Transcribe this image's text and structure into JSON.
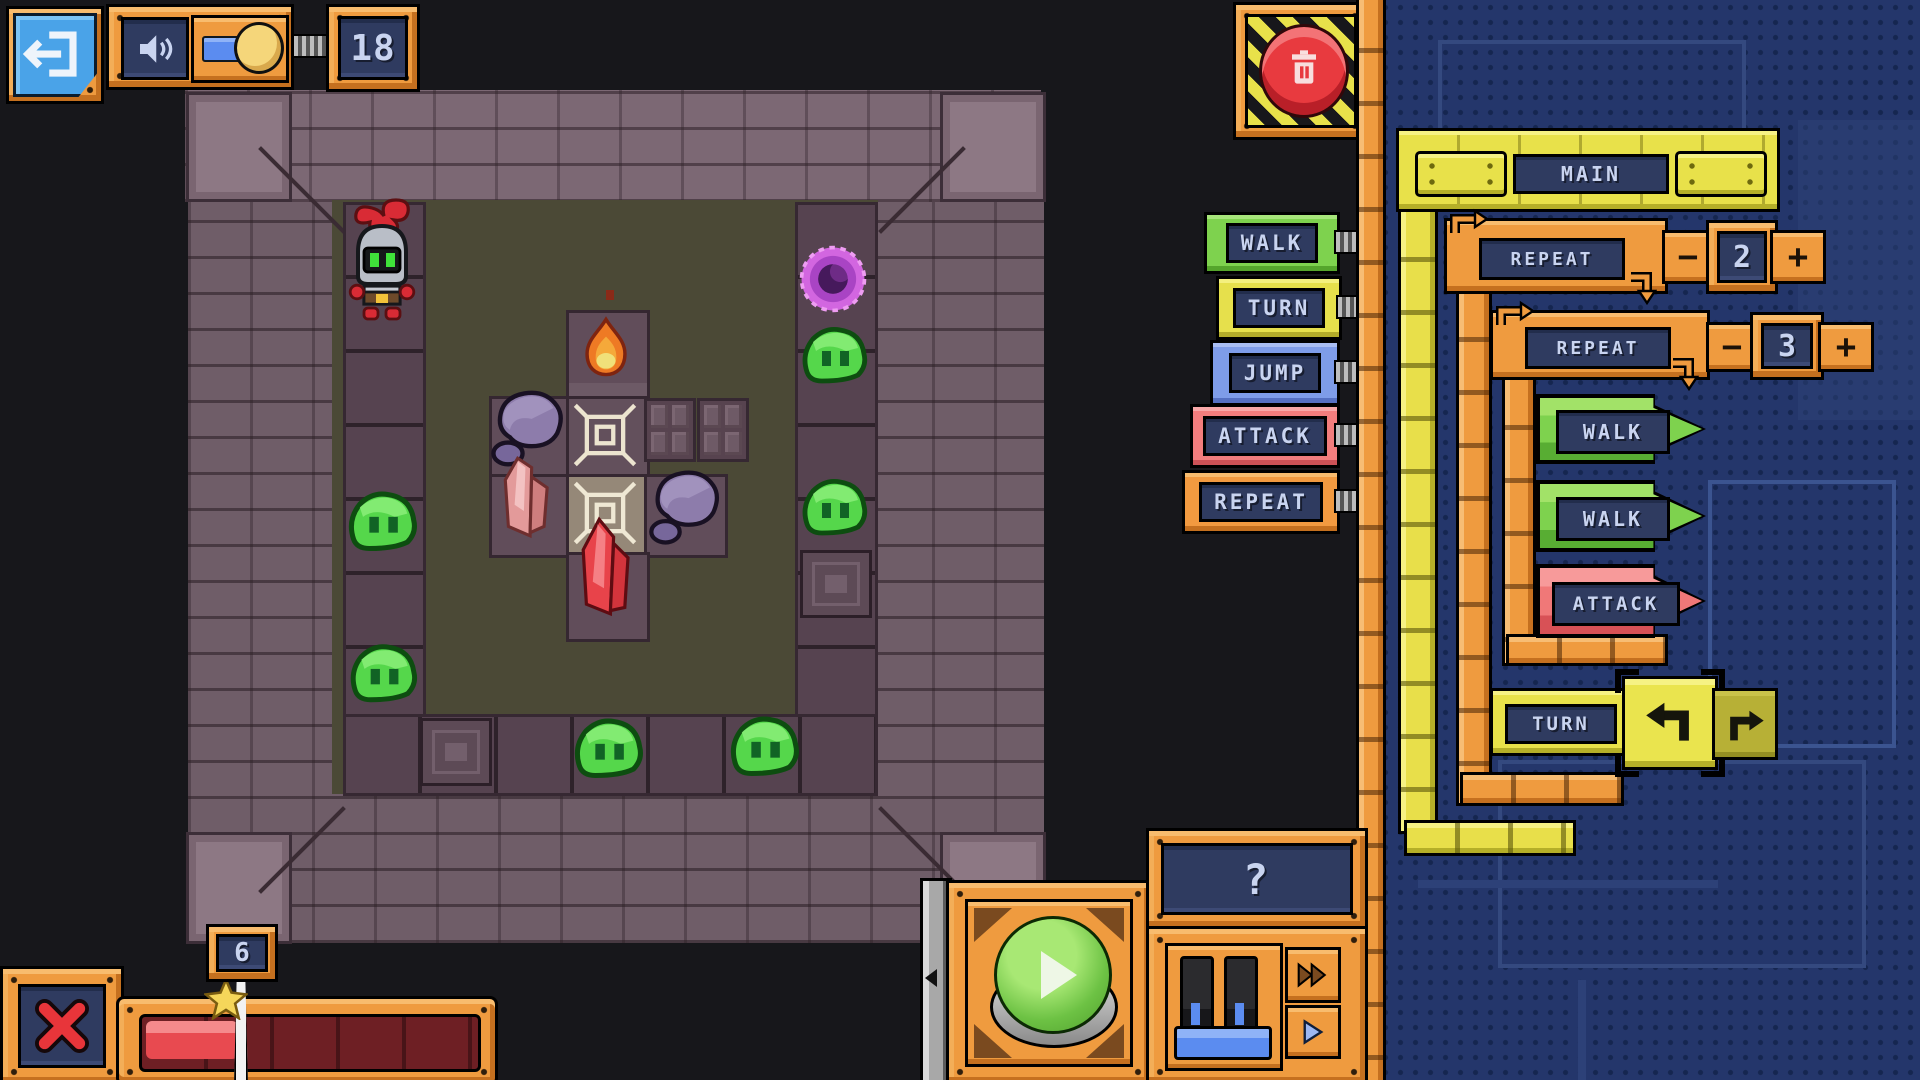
{
  "hud": {
    "block_counter": "18"
  },
  "palette": {
    "buttons": [
      {
        "label": "WALK",
        "color": "#7ed24e"
      },
      {
        "label": "TURN",
        "color": "#e6e04c"
      },
      {
        "label": "JUMP",
        "color": "#7e9ce8"
      },
      {
        "label": "ATTACK",
        "color": "#f27d7d"
      },
      {
        "label": "REPEAT",
        "color": "#f29a40"
      }
    ]
  },
  "program": {
    "main_label": "MAIN",
    "repeat_outer": {
      "label": "REPEAT",
      "count": "2",
      "minus": "−",
      "plus": "+"
    },
    "repeat_inner": {
      "label": "REPEAT",
      "count": "3",
      "minus": "−",
      "plus": "+"
    },
    "walk1_label": "WALK",
    "walk2_label": "WALK",
    "attack_label": "ATTACK",
    "turn_label": "TURN"
  },
  "controls": {
    "help_label": "?",
    "progress_marker": "6"
  },
  "icons": {
    "exit": "door-with-arrow",
    "sound": "speaker-waves",
    "volume_toggle": "slider-knob",
    "delete": "trash-can-on-hazard",
    "run": "green-play-button",
    "fast_forward": "double-arrow",
    "step": "small-play-arrow",
    "cancel": "red-x",
    "turn_left": "arrow-turn-left",
    "turn_right": "arrow-turn-right",
    "progress_star": "star-marker"
  },
  "game_sprites": [
    "knight",
    "slime",
    "portal",
    "flame",
    "pink-crystal",
    "red-crystal",
    "rock",
    "marked-tile"
  ],
  "colors": {
    "orange": "#ef9b3f",
    "navy_screen": "#2f3b60",
    "panel_blue": "#24366b",
    "yellow": "#e8e14a",
    "green": "#7ed24e",
    "slime_green": "#55d74b",
    "portal_purple": "#d266e0",
    "floor_olive": "#4b4936",
    "wall_mauve": "#6f5d68",
    "bar_red": "#e84a50"
  }
}
